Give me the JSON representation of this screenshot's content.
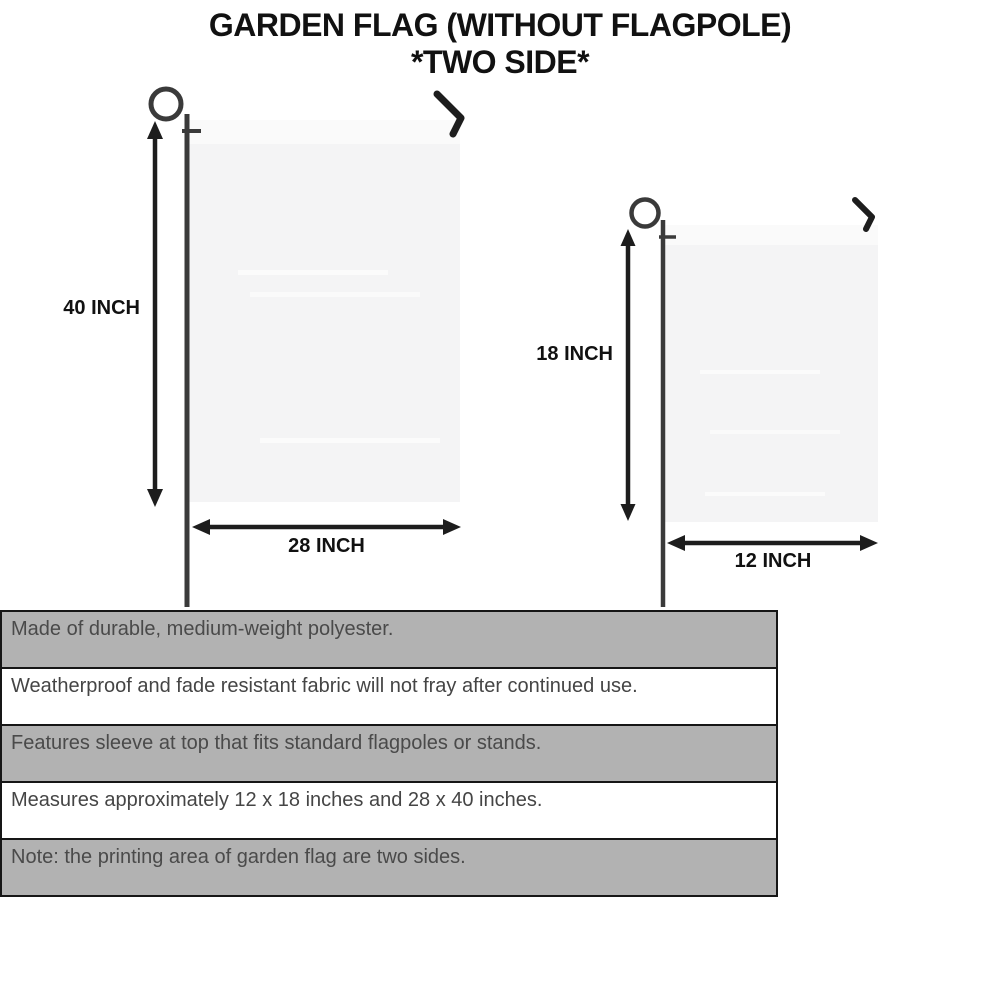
{
  "title": {
    "line1": "GARDEN FLAG (WITHOUT FLAGPOLE)",
    "line2": "*TWO SIDE*"
  },
  "diagram": {
    "large_flag": {
      "height_label": "40 INCH",
      "width_label": "28 INCH"
    },
    "small_flag": {
      "height_label": "18 INCH",
      "width_label": "12 INCH"
    }
  },
  "features": {
    "items": [
      {
        "text": "Made of durable, medium-weight polyester."
      },
      {
        "text": "Weatherproof and fade resistant fabric will not fray after continued use."
      },
      {
        "text": "Features sleeve at top that fits standard flagpoles or stands."
      },
      {
        "text": "Measures approximately 12 x 18 inches and 28 x 40 inches."
      },
      {
        "text": "Note: the printing area of garden flag are two sides."
      }
    ]
  },
  "colors": {
    "title_text": "#111111",
    "flag_fill": "#f4f4f5",
    "flag_sleeve": "#fafafa",
    "pole": "#3a3a3a",
    "arrow": "#1d1d1d",
    "bar_gray": "#b2b2b2",
    "bar_white": "#ffffff",
    "bar_border": "#161616",
    "bar_text": "#4a4a4a"
  }
}
